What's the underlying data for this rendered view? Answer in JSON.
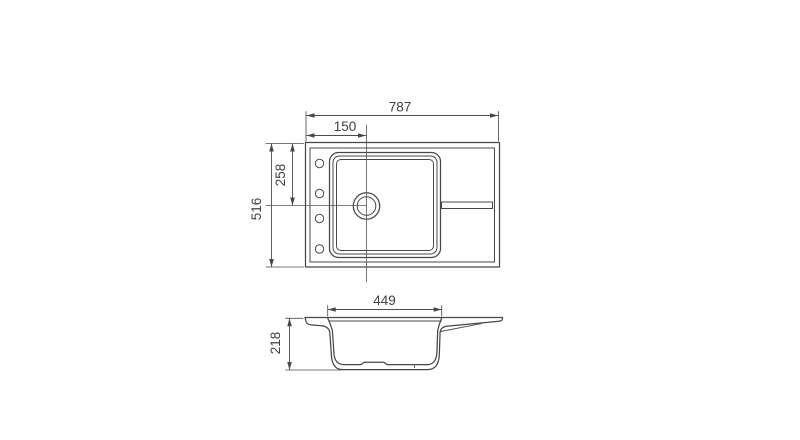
{
  "background_color": "#ffffff",
  "drawing": {
    "title": "Kitchen sink dimensional drawing",
    "line_color": "#474747",
    "text_color": "#3f3f3f",
    "top_view": {
      "dim_overall_width": "787",
      "dim_drain_offset_left": "150",
      "dim_overall_depth": "516",
      "dim_drain_offset_top": "258",
      "tap_hole_count": 4
    },
    "side_view": {
      "dim_bowl_width": "449",
      "dim_bowl_depth": "218"
    }
  }
}
